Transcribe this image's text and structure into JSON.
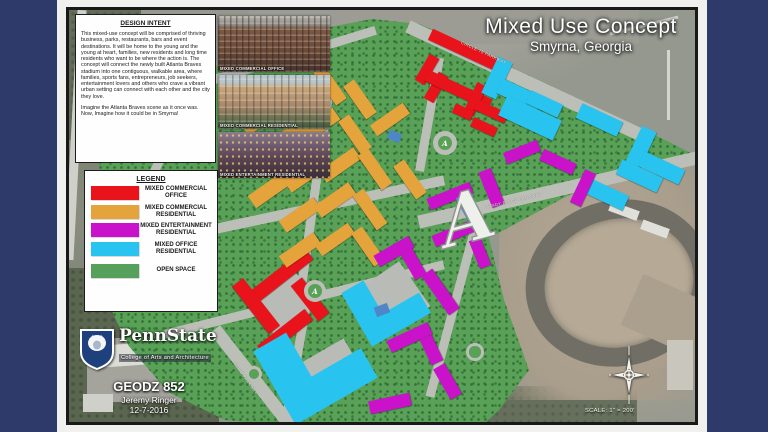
{
  "title": {
    "main": "Mixed Use Concept",
    "location": "Smyrna, Georgia"
  },
  "design_intent": {
    "heading": "DESIGN INTENT",
    "body": "This mixed-use concept will be comprised of thriving business, parks, restaurants, bars and event destinations. It will be home to the young and the young at heart, families, new residents and long time residents who want to be where the action is. The concept will connect the newly built Atlanta Braves stadium into one contiguous, walkable area, where families, sports fans, entrepreneurs, job seekers, entertainment lovers and others who crave a vibrant urban setting can connect with each other and the city they love.",
    "tagline": "Imagine the Atlanta Braves scene as it once was. Now, Imagine how it could be in Smyrna!"
  },
  "legend": {
    "heading": "LEGEND",
    "items": [
      {
        "label": "MIXED COMMERCIAL OFFICE",
        "color": "#e8131b"
      },
      {
        "label": "MIXED COMMERCIAL RESIDENTIAL",
        "color": "#e5a33c"
      },
      {
        "label": "MIXED ENTERTAINMENT RESIDENTIAL",
        "color": "#c912c9"
      },
      {
        "label": "MIXED OFFICE RESIDENTIAL",
        "color": "#28c4ef"
      },
      {
        "label": "OPEN SPACE",
        "color": "#55a05a"
      }
    ]
  },
  "renderings": [
    {
      "caption": "MIXED COMMERCIAL OFFICE"
    },
    {
      "caption": "MIXED COMMERCIAL RESIDENTIAL"
    },
    {
      "caption": "MIXED ENTERTAINMENT RESIDENTIAL"
    }
  ],
  "branding": {
    "university": "PennState",
    "college": "College of Arts and Architecture",
    "course": "GEODZ 852",
    "author": "Jeremy Ringer",
    "date": "12-7-2016"
  },
  "map": {
    "scale_label": "SCALE: 1\" = 200'",
    "braves_logo": "A",
    "roads": [
      {
        "label": "CIRCLE 75 PARKWAY"
      },
      {
        "label": "WINDY RIDGE PARKWAY"
      },
      {
        "label": "COBB PARKWAY"
      }
    ]
  }
}
